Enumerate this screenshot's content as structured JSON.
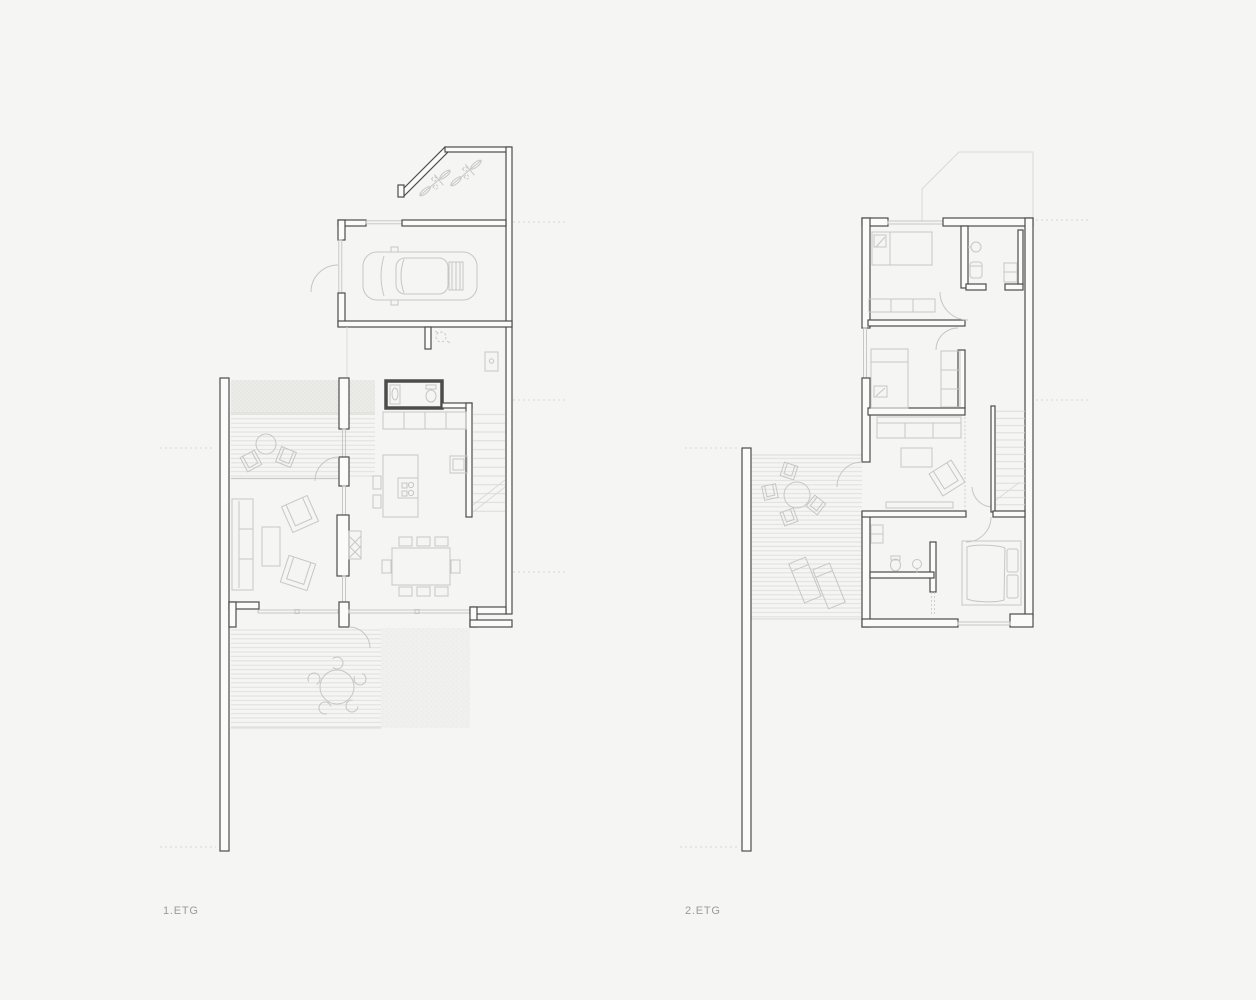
{
  "sheet": {
    "width": 1256,
    "height": 1000,
    "background": "#f5f5f4"
  },
  "labels": {
    "floor1": "1.ETG",
    "floor2": "2.ETG"
  },
  "colors": {
    "bg": "#f5f5f4",
    "wall": "#4c4c4c",
    "wallfill": "#fbfbfa",
    "furn": "#c6c6c3",
    "glass": "#c4c4c1",
    "deckline": "#dedddb",
    "gravel": "#d8d8d4",
    "ghost": "#d9d9d5",
    "dash": "#d6d6d2",
    "labeltext": "#9b9b99"
  },
  "plans": [
    {
      "id": "floor-1",
      "label": "1.ETG",
      "features": [
        "bike-shed",
        "bicycles",
        "garage",
        "car",
        "entry-hall",
        "wc",
        "bathroom",
        "kitchen-cabinets",
        "kitchen-island",
        "cooktop",
        "staircase",
        "dining-table",
        "fireplace",
        "sofa",
        "coffee-table",
        "armchairs",
        "side-deck",
        "deck-table",
        "garden-terrace",
        "terrace-table",
        "gravel-patch",
        "site-wall"
      ]
    },
    {
      "id": "floor-2",
      "label": "2.ETG",
      "features": [
        "ghost-outline-below",
        "bedroom-1",
        "bed-1",
        "wardrobe",
        "bathroom-1",
        "bedroom-2",
        "bed-2",
        "closet",
        "tv-lounge",
        "sofa",
        "coffee-table",
        "armchair",
        "tv-bench",
        "staircase",
        "bathroom-2",
        "walk-in-closet",
        "master-bedroom",
        "master-bed",
        "roof-terrace",
        "terrace-table",
        "terrace-chairs",
        "sun-loungers",
        "site-wall"
      ]
    }
  ]
}
